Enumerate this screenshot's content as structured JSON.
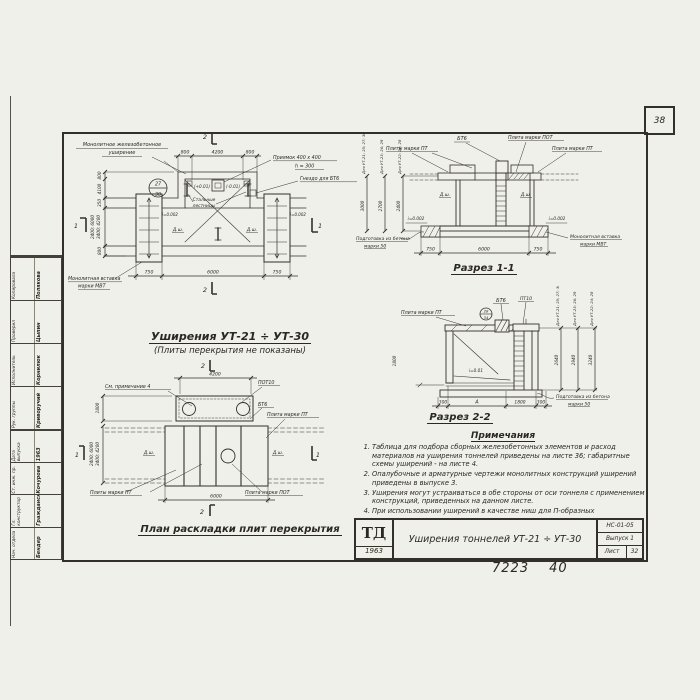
{
  "sheet": {
    "corner_number": "38",
    "footer_code": "7223",
    "footer_page": "40"
  },
  "stamp": {
    "lower": [
      {
        "role": "Нач. отдела",
        "name": "Бендер"
      },
      {
        "role": "Гл. конструктор",
        "name": "Гражданский"
      },
      {
        "role": "Ст. инж. пр.",
        "name": "Кочурова"
      },
      {
        "role": "Дата выпуска",
        "name": "1963"
      }
    ],
    "upper": [
      {
        "role": "Рук. группы",
        "name": "Криворучий"
      },
      {
        "role": "Исполнитель",
        "name": "Корнилюк"
      },
      {
        "role": "Проверил",
        "name": "Цыпин"
      },
      {
        "role": "Копировала",
        "name": "Полякова"
      }
    ]
  },
  "plan_top": {
    "title": "Уширения УТ-21 ÷ УТ-30",
    "subtitle": "(Плиты перекрытия не показаны)",
    "labels": {
      "widening1": "Монолитное железобетонное",
      "widening2": "уширение",
      "pit1": "Приямок 400 х 400",
      "pit2": "h = 300",
      "socket": "Гнездо для БТ6",
      "ladders1": "Стальные",
      "ladders2": "лестницы",
      "insert1": "Монолитная вставка",
      "insert2": "марки МВТ",
      "elev_left": "(+0.01)",
      "elev_right": "(-0.01)",
      "slope_left": "i=0.002",
      "slope_right": "i=0.002",
      "dsh": "Д.ш.",
      "detail_top": "27",
      "detail_bottom": "30"
    },
    "dims": {
      "top": [
        "800",
        "4200",
        "800"
      ],
      "bottom": [
        "750",
        "6000",
        "750"
      ],
      "left": [
        "800",
        "4100",
        "350",
        "800"
      ],
      "tunnel_a": "2400; 6000",
      "tunnel_b": "3400; 4200"
    },
    "marks": {
      "sec2": "2",
      "sec1": "1"
    }
  },
  "section1": {
    "title": "Разрез 1-1",
    "labels": {
      "bt6": "БТ6",
      "pot": "Плита марки ПОТ",
      "pt_left": "Плиты марки ПТ",
      "pt_right": "Плита марки ПТ",
      "insert1": "Монолитная вставка",
      "insert2": "марки МВТ",
      "prep1": "Подготовка из бетона",
      "prep2": "марки 50",
      "dsh": "Д.ш.",
      "slope": "i=0.002"
    },
    "dims": {
      "bottom": [
        "750",
        "6000",
        "750"
      ]
    },
    "heights": [
      {
        "label": "Для УТ-21; 25; 27; 30",
        "value": "3000"
      },
      {
        "label": "Для УТ-23; 26; 29",
        "value": "2700"
      },
      {
        "label": "Для УТ-22; 24; 28",
        "value": "2400"
      }
    ]
  },
  "section2": {
    "title": "Разрез 2-2",
    "labels": {
      "pt": "Плита марки ПТ",
      "bt6": "БТ6",
      "pt10": "ПТ10",
      "slope": "i=0.01",
      "prep1": "Подготовка из бетона",
      "prep2": "марки 50",
      "detail_top": "28",
      "detail_bottom": "34"
    },
    "dims": {
      "bottom": [
        "300",
        "А",
        "1800",
        "300"
      ],
      "left": "1800"
    },
    "heights": [
      {
        "label": "Для УТ-21; 25; 27; 30",
        "value": "2640"
      },
      {
        "label": "Для УТ-23; 26; 29",
        "value": "2940"
      },
      {
        "label": "Для УТ-22; 24; 28",
        "value": "3240"
      }
    ]
  },
  "plan_bottom": {
    "title": "План раскладки плит перекрытия",
    "labels": {
      "note_ref": "См. примечание 4",
      "pot10": "ПОТ10",
      "bt6": "БТ6",
      "pt": "Плита марки ПТ",
      "pt_plural": "Плиты марки ПТ",
      "pot": "Плита марки ПОТ",
      "dsh": "Д.ш."
    },
    "dims": {
      "top": "4200",
      "bottom": "6000",
      "left": "1800",
      "tunnel_a": "2400; 6000",
      "tunnel_b": "3400; 4200"
    },
    "marks": {
      "sec2": "2",
      "sec1": "1"
    }
  },
  "notes": {
    "title": "Примечания",
    "items": [
      {
        "num": "1.",
        "text": "Таблица для подбора сборных железобетонных элементов и расход материалов на уширения тоннелей приведены на листе 36; габаритные схемы уширений - на листе 4."
      },
      {
        "num": "2.",
        "text": "Опалубочные и арматурные чертежи монолитных конструкций уширений приведены в выпуске 3."
      },
      {
        "num": "3.",
        "text": "Уширения могут устраиваться в обе стороны от оси тоннеля с применением конструкций, приведенных на данном листе."
      },
      {
        "num": "4.",
        "text": "При использовании уширений в качестве ниш для П-образных компенсаторов, люки в перекрытиях не устраиваются."
      }
    ]
  },
  "title_block": {
    "logo_top": "ТД",
    "logo_year": "1963",
    "title": "Уширения тоннелей УТ-21 ÷ УТ-30",
    "doc_code": "НС-01-05",
    "issue": "Выпуск 1",
    "sheet_label": "Лист",
    "sheet_number": "32"
  }
}
